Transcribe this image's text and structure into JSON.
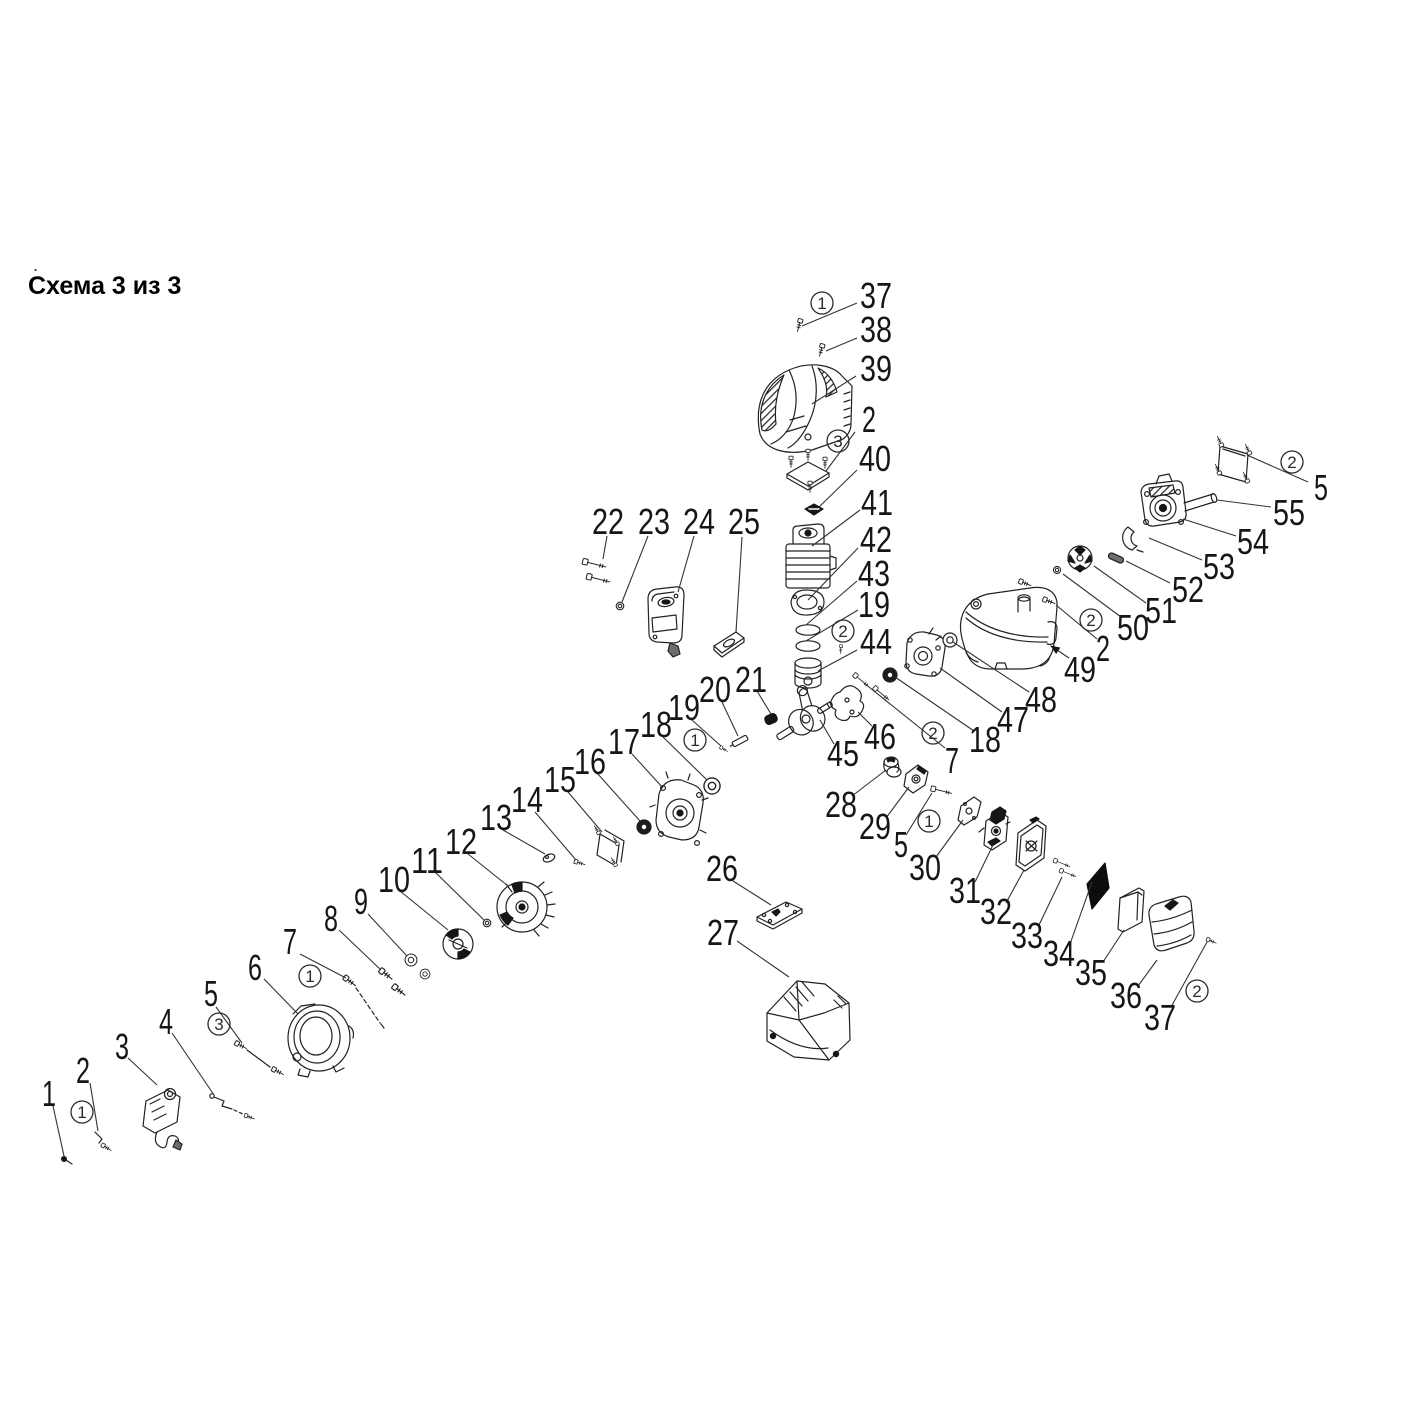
{
  "title": "Схема 3 из 3",
  "artifact_dot": ".",
  "colors": {
    "ink": "#222222",
    "leader": "#333333",
    "background": "#ffffff"
  },
  "diagram": {
    "type": "exploded-parts-diagram",
    "part_labels": [
      {
        "text": "37",
        "x": 876,
        "y": 295,
        "line": [
          857,
          303,
          802,
          326
        ]
      },
      {
        "text": "38",
        "x": 876,
        "y": 329,
        "line": [
          857,
          338,
          826,
          351
        ]
      },
      {
        "text": "39",
        "x": 876,
        "y": 368,
        "line": [
          856,
          376,
          812,
          404
        ]
      },
      {
        "text": "2",
        "x": 869,
        "y": 419,
        "line": [
          855,
          432,
          826,
          471
        ]
      },
      {
        "text": "40",
        "x": 875,
        "y": 458,
        "line": [
          857,
          470,
          819,
          507
        ]
      },
      {
        "text": "41",
        "x": 877,
        "y": 502,
        "line": [
          860,
          510,
          812,
          546
        ]
      },
      {
        "text": "42",
        "x": 876,
        "y": 539,
        "line": [
          858,
          548,
          808,
          600
        ]
      },
      {
        "text": "43",
        "x": 874,
        "y": 573,
        "line": [
          857,
          581,
          806,
          625
        ]
      },
      {
        "text": "19",
        "x": 874,
        "y": 604,
        "line": [
          858,
          610,
          806,
          641
        ]
      },
      {
        "text": "44",
        "x": 876,
        "y": 641,
        "line": [
          857,
          650,
          818,
          671
        ]
      },
      {
        "text": "5",
        "x": 1321,
        "y": 487,
        "line": [
          1308,
          482,
          1247,
          455
        ]
      },
      {
        "text": "55",
        "x": 1289,
        "y": 512,
        "line": [
          1271,
          507,
          1217,
          500
        ]
      },
      {
        "text": "54",
        "x": 1253,
        "y": 541,
        "line": [
          1236,
          536,
          1183,
          519
        ]
      },
      {
        "text": "53",
        "x": 1219,
        "y": 566,
        "line": [
          1202,
          560,
          1149,
          538
        ]
      },
      {
        "text": "52",
        "x": 1188,
        "y": 589,
        "line": [
          1170,
          583,
          1126,
          561
        ]
      },
      {
        "text": "51",
        "x": 1161,
        "y": 610,
        "line": [
          1146,
          603,
          1094,
          566
        ]
      },
      {
        "text": "50",
        "x": 1133,
        "y": 627,
        "line": [
          1121,
          617,
          1063,
          574
        ]
      },
      {
        "text": "2",
        "x": 1103,
        "y": 648,
        "line": [
          1097,
          639,
          1056,
          605
        ]
      },
      {
        "text": "49",
        "x": 1080,
        "y": 669,
        "line": [
          1069,
          658,
          1051,
          646
        ],
        "arrow": true
      },
      {
        "text": "48",
        "x": 1041,
        "y": 699,
        "line": [
          1029,
          692,
          953,
          642
        ]
      },
      {
        "text": "47",
        "x": 1013,
        "y": 719,
        "line": [
          1002,
          712,
          940,
          668
        ]
      },
      {
        "text": "18",
        "x": 985,
        "y": 739,
        "line": [
          974,
          731,
          895,
          677
        ]
      },
      {
        "text": "7",
        "x": 952,
        "y": 760,
        "line": [
          945,
          748,
          864,
          683
        ]
      },
      {
        "text": "46",
        "x": 880,
        "y": 736,
        "line": [
          872,
          726,
          858,
          712
        ]
      },
      {
        "text": "45",
        "x": 843,
        "y": 753,
        "line": [
          834,
          744,
          820,
          720
        ]
      },
      {
        "text": "22",
        "x": 608,
        "y": 521,
        "line": [
          607,
          536,
          603,
          559
        ]
      },
      {
        "text": "23",
        "x": 654,
        "y": 521,
        "line": [
          648,
          536,
          622,
          602
        ]
      },
      {
        "text": "24",
        "x": 699,
        "y": 521,
        "line": [
          694,
          536,
          678,
          592
        ]
      },
      {
        "text": "25",
        "x": 744,
        "y": 521,
        "line": [
          742,
          537,
          736,
          632
        ]
      },
      {
        "text": "21",
        "x": 751,
        "y": 679,
        "line": [
          757,
          691,
          771,
          714
        ]
      },
      {
        "text": "20",
        "x": 715,
        "y": 689,
        "line": [
          722,
          702,
          738,
          736
        ]
      },
      {
        "text": "19",
        "x": 684,
        "y": 707,
        "line": [
          692,
          720,
          721,
          746
        ]
      },
      {
        "text": "18",
        "x": 656,
        "y": 724,
        "line": [
          663,
          737,
          707,
          780
        ]
      },
      {
        "text": "17",
        "x": 624,
        "y": 741,
        "line": [
          632,
          754,
          663,
          788
        ]
      },
      {
        "text": "16",
        "x": 590,
        "y": 761,
        "line": [
          597,
          773,
          640,
          821
        ]
      },
      {
        "text": "15",
        "x": 560,
        "y": 779,
        "line": [
          568,
          792,
          602,
          832
        ]
      },
      {
        "text": "14",
        "x": 527,
        "y": 799,
        "line": [
          535,
          812,
          576,
          860
        ]
      },
      {
        "text": "13",
        "x": 496,
        "y": 817,
        "line": [
          503,
          830,
          545,
          854
        ]
      },
      {
        "text": "12",
        "x": 461,
        "y": 841,
        "line": [
          468,
          854,
          508,
          886
        ]
      },
      {
        "text": "11",
        "x": 427,
        "y": 860,
        "line": [
          435,
          872,
          484,
          920
        ]
      },
      {
        "text": "10",
        "x": 394,
        "y": 879,
        "line": [
          400,
          891,
          448,
          930
        ]
      },
      {
        "text": "9",
        "x": 361,
        "y": 901,
        "line": [
          368,
          914,
          407,
          956
        ]
      },
      {
        "text": "8",
        "x": 331,
        "y": 918,
        "line": [
          339,
          930,
          381,
          970
        ]
      },
      {
        "text": "7",
        "x": 290,
        "y": 941,
        "line": [
          300,
          954,
          346,
          978
        ]
      },
      {
        "text": "6",
        "x": 255,
        "y": 967,
        "line": [
          264,
          979,
          298,
          1014
        ]
      },
      {
        "text": "5",
        "x": 211,
        "y": 993,
        "line": [
          216,
          1007,
          242,
          1043
        ]
      },
      {
        "text": "4",
        "x": 166,
        "y": 1021,
        "line": [
          172,
          1033,
          214,
          1095
        ]
      },
      {
        "text": "3",
        "x": 122,
        "y": 1046,
        "line": [
          128,
          1058,
          157,
          1085
        ]
      },
      {
        "text": "2",
        "x": 83,
        "y": 1070,
        "line": [
          90,
          1083,
          98,
          1131
        ]
      },
      {
        "text": "1",
        "x": 49,
        "y": 1093,
        "line": [
          53,
          1106,
          64,
          1156
        ]
      },
      {
        "text": "26",
        "x": 722,
        "y": 868,
        "line": [
          733,
          881,
          771,
          905
        ]
      },
      {
        "text": "27",
        "x": 723,
        "y": 932,
        "line": [
          737,
          941,
          789,
          977
        ]
      },
      {
        "text": "28",
        "x": 841,
        "y": 804,
        "line": [
          852,
          796,
          886,
          770
        ]
      },
      {
        "text": "29",
        "x": 875,
        "y": 826,
        "line": [
          886,
          818,
          909,
          787
        ]
      },
      {
        "text": "5",
        "x": 901,
        "y": 844,
        "line": [
          906,
          835,
          932,
          793
        ]
      },
      {
        "text": "30",
        "x": 925,
        "y": 867,
        "line": [
          936,
          857,
          963,
          820
        ]
      },
      {
        "text": "31",
        "x": 965,
        "y": 890,
        "line": [
          975,
          882,
          993,
          845
        ]
      },
      {
        "text": "32",
        "x": 996,
        "y": 911,
        "line": [
          1006,
          903,
          1024,
          870
        ]
      },
      {
        "text": "33",
        "x": 1027,
        "y": 935,
        "line": [
          1039,
          925,
          1062,
          877
        ]
      },
      {
        "text": "34",
        "x": 1059,
        "y": 953,
        "line": [
          1070,
          944,
          1092,
          882
        ]
      },
      {
        "text": "35",
        "x": 1091,
        "y": 972,
        "line": [
          1103,
          962,
          1124,
          930
        ]
      },
      {
        "text": "36",
        "x": 1126,
        "y": 995,
        "line": [
          1138,
          986,
          1157,
          960
        ]
      },
      {
        "text": "37",
        "x": 1160,
        "y": 1017,
        "line": [
          1171,
          1007,
          1207,
          942
        ]
      }
    ],
    "circled_markers": [
      {
        "text": "1",
        "x": 822,
        "y": 303
      },
      {
        "text": "3",
        "x": 838,
        "y": 441
      },
      {
        "text": "2",
        "x": 843,
        "y": 631
      },
      {
        "text": "2",
        "x": 1292,
        "y": 462
      },
      {
        "text": "2",
        "x": 1091,
        "y": 620
      },
      {
        "text": "2",
        "x": 933,
        "y": 733
      },
      {
        "text": "1",
        "x": 695,
        "y": 740
      },
      {
        "text": "1",
        "x": 310,
        "y": 976
      },
      {
        "text": "3",
        "x": 219,
        "y": 1024
      },
      {
        "text": "1",
        "x": 82,
        "y": 1112
      },
      {
        "text": "1",
        "x": 929,
        "y": 821
      },
      {
        "text": "2",
        "x": 1197,
        "y": 991
      }
    ]
  }
}
